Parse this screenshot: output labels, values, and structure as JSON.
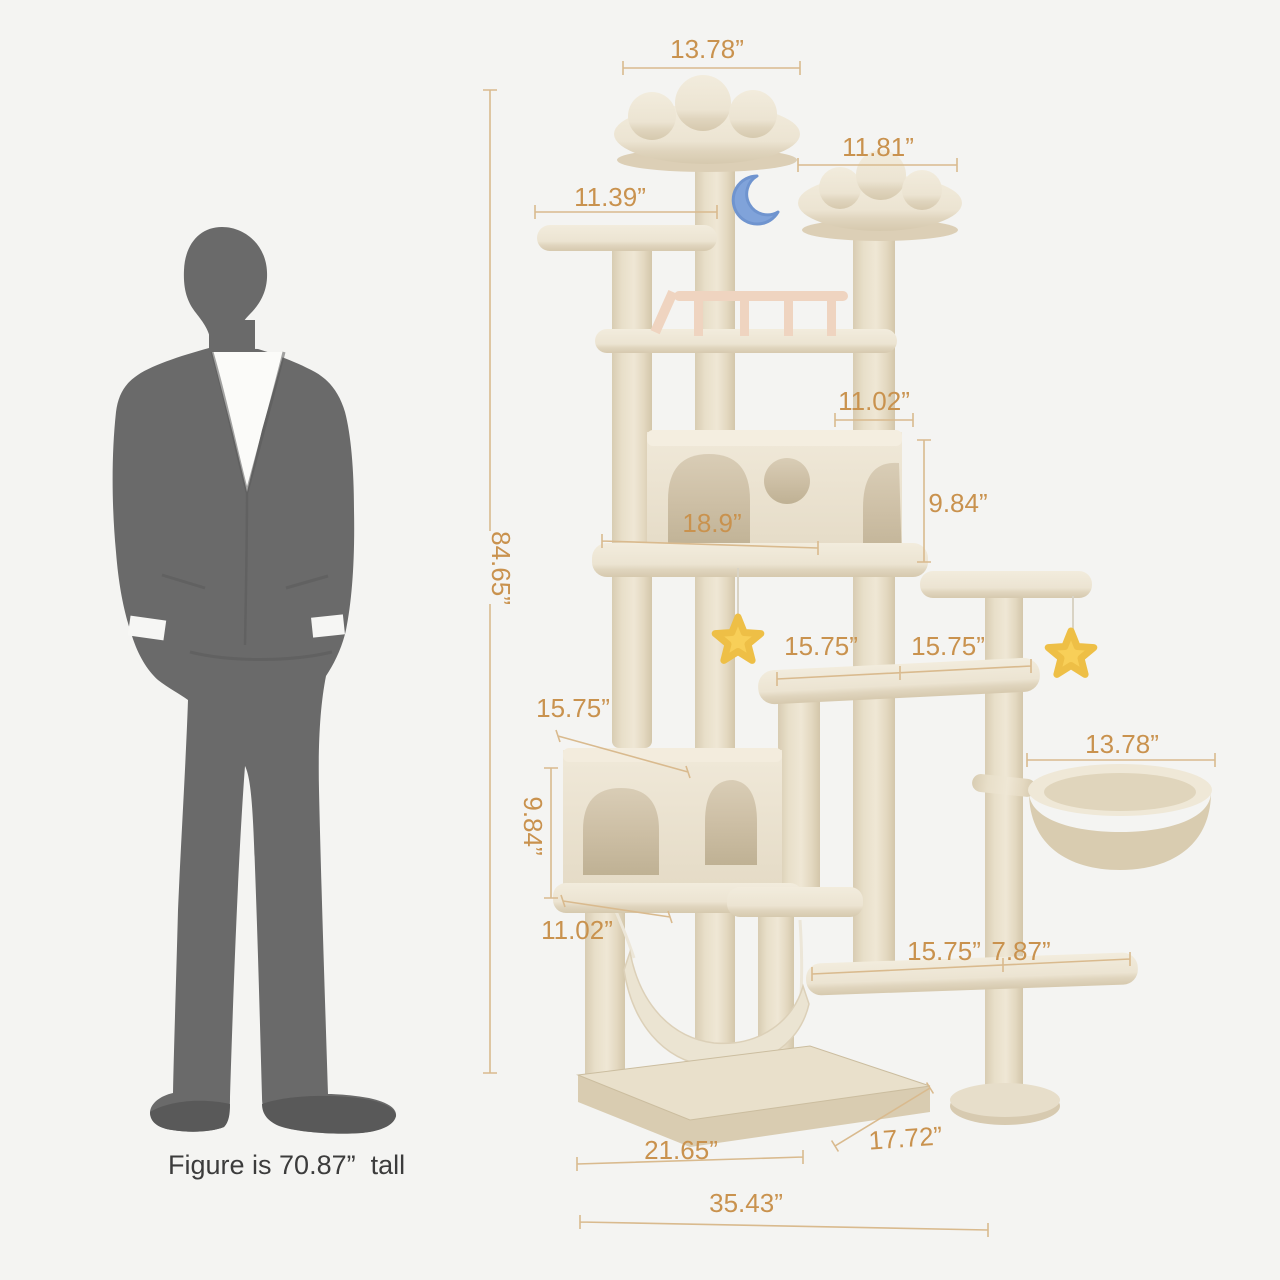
{
  "caption": "Figure is 70.87”  tall",
  "dimensions": {
    "top_perch_width": "13.78”",
    "upper_right_perch_width": "11.81”",
    "upper_left_perch_width": "11.39”",
    "total_height": "84.65”",
    "upper_condo_top_depth": "11.02”",
    "upper_condo_height": "9.84”",
    "upper_condo_width": "18.9”",
    "mid_platform_left_width": "15.75”",
    "mid_platform_right_width": "15.75”",
    "lower_condo_width": "15.75”",
    "lower_condo_height": "9.84”",
    "lower_condo_depth": "11.02”",
    "hanging_basket_width": "13.78”",
    "bottom_step_width": "15.75”",
    "bottom_step_depth": "7.87”",
    "base_front_width": "21.65”",
    "base_side_depth": "17.72”",
    "overall_width": "35.43”"
  },
  "colors": {
    "background": "#f4f4f2",
    "dimension_text": "#c9924e",
    "dimension_line": "#d9ba8e",
    "silhouette": "#6a6a6a",
    "tree_plush": "#efe7d6",
    "star_toy": "#f8cf58",
    "moon_toy": "#80a3da"
  }
}
